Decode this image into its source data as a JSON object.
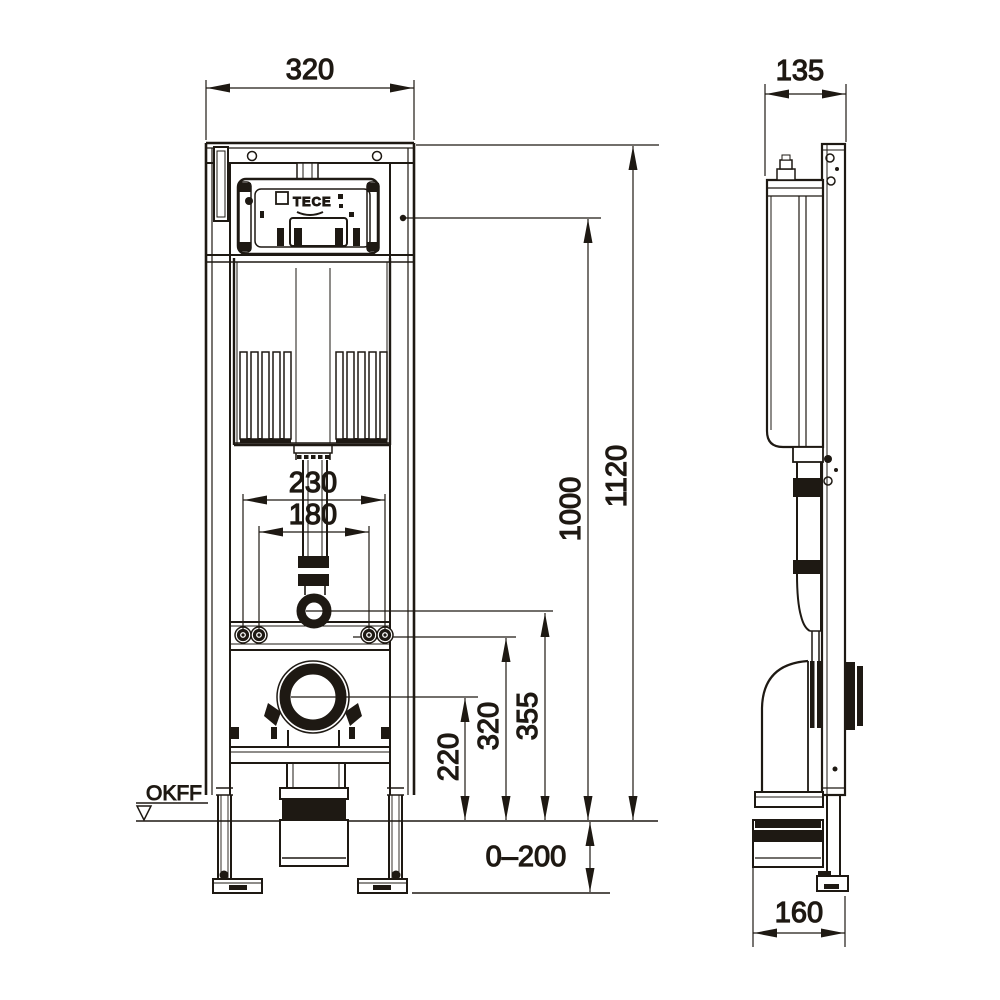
{
  "drawing": {
    "logo": "TECE",
    "front_view": {
      "dim_width_top": "320",
      "dim_cistern_width": "230",
      "dim_bolt_spacing": "180",
      "dim_total_height": "1120",
      "dim_height_1000": "1000",
      "dim_flush_pipe_height": "355",
      "dim_fixing_bolt_height": "320",
      "dim_outlet_height": "220",
      "dim_foot_adjust_range": "0–200",
      "floor_level_label": "OKFF"
    },
    "side_view": {
      "dim_depth_top": "135",
      "dim_depth_bottom": "160"
    },
    "ink_color": "#1e1913"
  }
}
